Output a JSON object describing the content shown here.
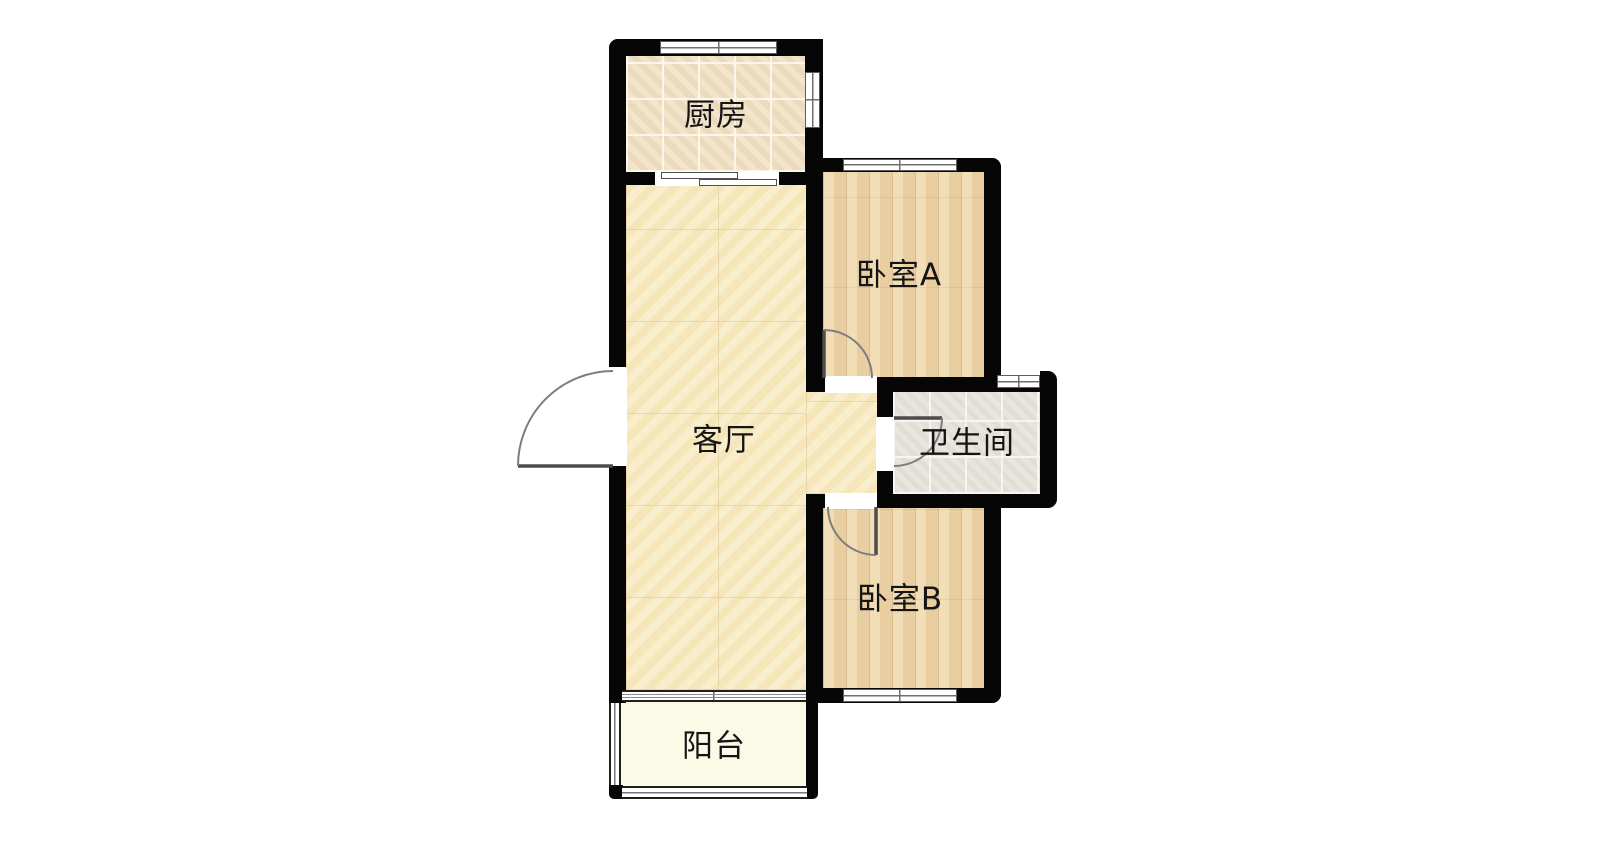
{
  "rooms": {
    "kitchen": {
      "label": "厨房"
    },
    "bedroom_a": {
      "label": "卧室A"
    },
    "living_room": {
      "label": "客厅"
    },
    "bathroom": {
      "label": "卫生间"
    },
    "bedroom_b": {
      "label": "卧室B"
    },
    "balcony": {
      "label": "阳台"
    }
  },
  "palette": {
    "wall": "#060606",
    "kitchen_floor": "#f0e1c5",
    "living_room_floor": "#f7e9c1",
    "bedroom_floor": "#ecd4a7",
    "bathroom_floor": "#e6e3dc",
    "balcony_floor": "#fafae6",
    "door_swing": "#7d7d7d",
    "window_frame": "#5d5d5d",
    "label_text": "#151515",
    "background": "#ffffff"
  }
}
